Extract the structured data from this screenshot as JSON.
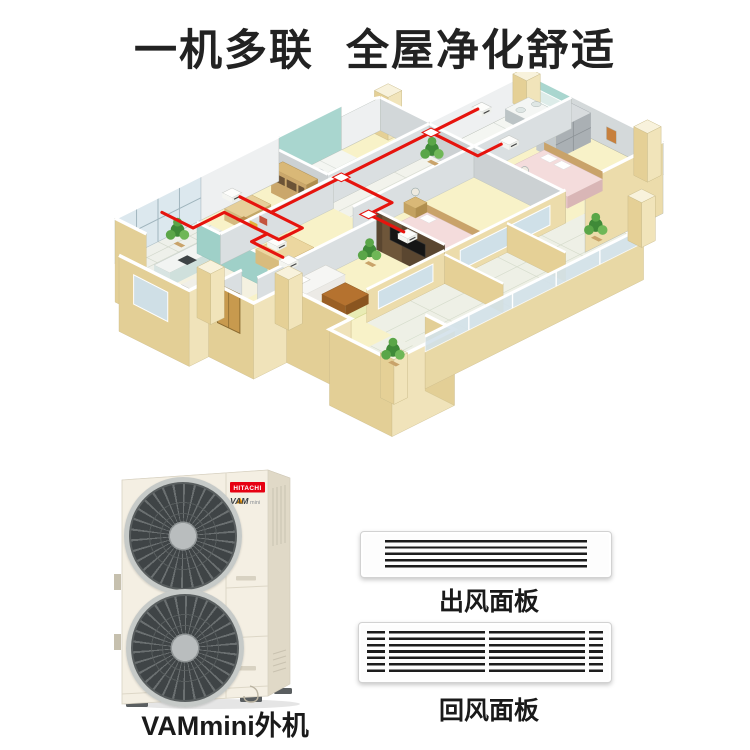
{
  "page": {
    "title": "一机多联 全屋净化舒适"
  },
  "outdoor_unit": {
    "brand": "HITACHI",
    "model": "VAM",
    "model_suffix": "mini",
    "caption": "VAMmini外机"
  },
  "panels": {
    "outlet": {
      "caption": "出风面板"
    },
    "return": {
      "caption": "回风面板"
    }
  },
  "colors": {
    "pipe_red": "#e6140e",
    "brand_red": "#e60012",
    "wall_cream": "#e5d096",
    "bath_teal": "#a9d6cf",
    "floor_yellow": "#f8f2c8",
    "title_ink": "#222222"
  }
}
